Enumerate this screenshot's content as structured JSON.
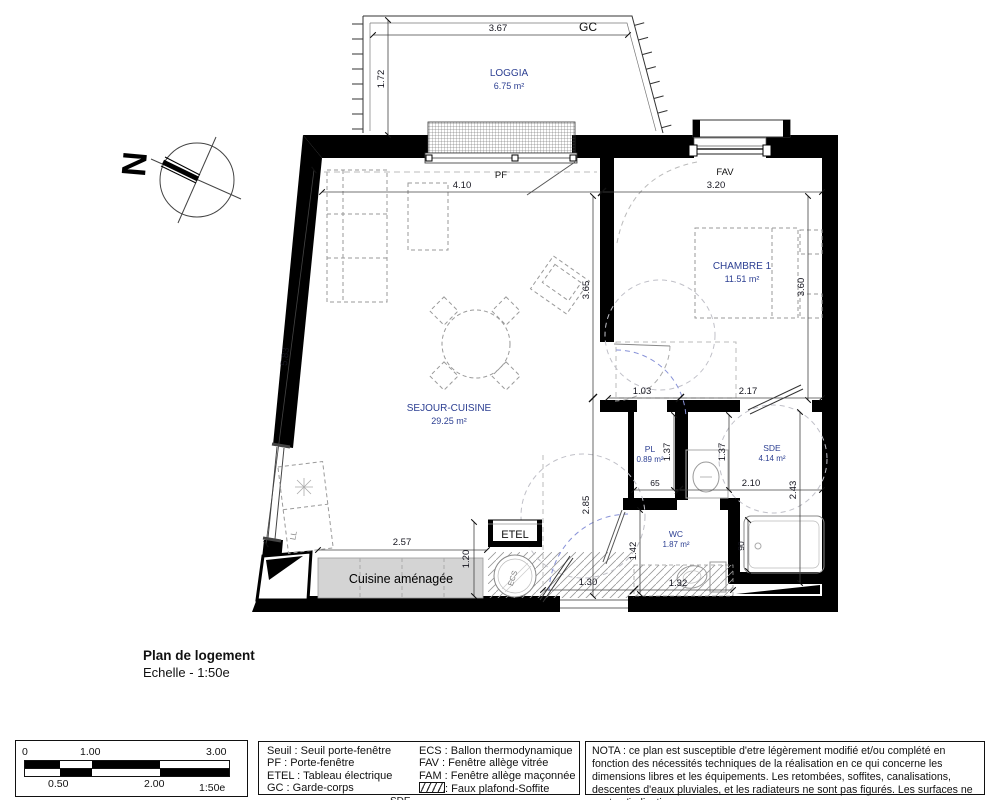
{
  "title": {
    "line1": "Plan de logement",
    "line2": "Echelle - 1:50e"
  },
  "plan": {
    "north_label": {
      "t": "N",
      "x": 146,
      "y": 165,
      "r": -85
    },
    "rooms": [
      {
        "name": "LOGGIA",
        "area": "6.75 m²",
        "x": 509,
        "y": 76,
        "small": false
      },
      {
        "name": "CHAMBRE 1",
        "area": "11.51 m²",
        "x": 742,
        "y": 269,
        "small": false
      },
      {
        "name": "SEJOUR-CUISINE",
        "area": "29.25 m²",
        "x": 449,
        "y": 411,
        "small": false
      },
      {
        "name": "PL",
        "area": "0.89 m²",
        "x": 650,
        "y": 452,
        "small": true
      },
      {
        "name": "SDE",
        "area": "4.14 m²",
        "x": 772,
        "y": 451,
        "small": true
      },
      {
        "name": "WC",
        "area": "1.87 m²",
        "x": 676,
        "y": 537,
        "small": true
      }
    ],
    "dimensions": [
      {
        "t": "3.67",
        "x": 498,
        "y": 31
      },
      {
        "t": "1.72",
        "x": 384,
        "y": 79,
        "r": -90
      },
      {
        "t": "4.10",
        "x": 462,
        "y": 188
      },
      {
        "t": "3.20",
        "x": 716,
        "y": 188
      },
      {
        "t": "5.83",
        "x": 288,
        "y": 357,
        "r": -83
      },
      {
        "t": "3.65",
        "x": 589,
        "y": 290,
        "r": -90
      },
      {
        "t": "3.60",
        "x": 804,
        "y": 287,
        "r": -90
      },
      {
        "t": "1.03",
        "x": 642,
        "y": 394
      },
      {
        "t": "2.17",
        "x": 748,
        "y": 394
      },
      {
        "t": "1.37",
        "x": 670,
        "y": 452,
        "r": -90
      },
      {
        "t": "1.37",
        "x": 725,
        "y": 452,
        "r": -90
      },
      {
        "t": "65",
        "x": 655,
        "y": 486,
        "sm": true
      },
      {
        "t": "2.10",
        "x": 751,
        "y": 486
      },
      {
        "t": "2.43",
        "x": 796,
        "y": 490,
        "r": -90
      },
      {
        "t": "2.85",
        "x": 589,
        "y": 505,
        "r": -90
      },
      {
        "t": "1.42",
        "x": 636,
        "y": 551,
        "r": -90
      },
      {
        "t": "90",
        "x": 744,
        "y": 546,
        "r": -90,
        "sm": true
      },
      {
        "t": "2.57",
        "x": 402,
        "y": 545
      },
      {
        "t": "1.20",
        "x": 469,
        "y": 559,
        "r": -90
      },
      {
        "t": "1.30",
        "x": 588,
        "y": 585
      },
      {
        "t": "1.32",
        "x": 678,
        "y": 586
      }
    ],
    "annotations": [
      {
        "t": "GC",
        "x": 588,
        "y": 31,
        "cls": "gc"
      },
      {
        "t": "PF",
        "x": 501,
        "y": 178,
        "cls": "ann"
      },
      {
        "t": "FAV",
        "x": 725,
        "y": 175,
        "cls": "ann"
      },
      {
        "t": "ETEL",
        "x": 515,
        "y": 538,
        "cls": "etel"
      },
      {
        "t": "ECS",
        "x": 515,
        "y": 579,
        "cls": "ecs",
        "r": -72
      },
      {
        "t": "LL",
        "x": 296,
        "y": 536,
        "cls": "ll",
        "r": -80
      },
      {
        "t": "Cuisine aménagée",
        "x": 401,
        "y": 583,
        "cls": "kitchen-label"
      }
    ]
  },
  "scale_bar": {
    "labels_top": [
      "0",
      "1.00",
      "3.00"
    ],
    "labels_bottom": [
      "0.50",
      "2.00"
    ],
    "ratio": "1:50e"
  },
  "legend": {
    "col1": [
      "Seuil : Seuil porte-fenêtre",
      "PF : Porte-fenêtre",
      "ETEL : Tableau électrique",
      "GC : Garde-corps"
    ],
    "col2": [
      "ECS : Ballon thermodynamique",
      "FAV : Fenêtre allège vitrée",
      "FAM : Fenêtre allège maçonnée"
    ],
    "hatch_label": ": Faux plafond-Soffite",
    "cutoff_text": "SDE"
  },
  "nota": {
    "text": "NOTA : ce plan est susceptible d'etre légèrement modifié et/ou complété en fonction des nécessités techniques de la réalisation en ce qui concerne les dimensions libres et les équipements. Les retombées, soffites, canalisations, descentes d'eaux pluviales, et les radiateurs ne sont pas figurés. Les surfaces ne sont qu'indicatives."
  }
}
